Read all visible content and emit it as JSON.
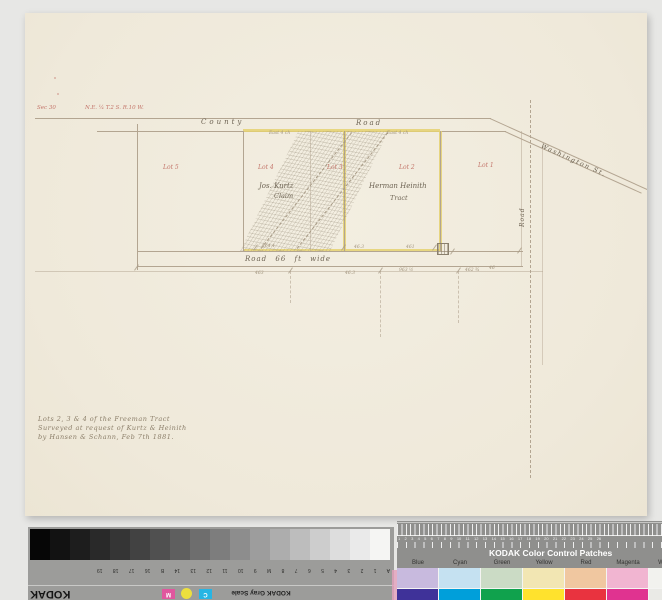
{
  "map": {
    "corner_note": {
      "section": "Sec 30",
      "township": "N.E. ¼  T.2 S.  R.10 W."
    },
    "labels": {
      "county": "County",
      "road_top": "Road",
      "washington": "Washington St.",
      "road_vertical": "Road",
      "road_bottom": "Road   66 ft wide"
    },
    "lots": [
      {
        "label": "Lot 5"
      },
      {
        "label": "Lot 4"
      },
      {
        "label": "Lot 3"
      },
      {
        "label": "Lot 2"
      },
      {
        "label": "Lot 1"
      }
    ],
    "tracts": [
      {
        "line1": "Jos. Kurtz",
        "line2": "Claim"
      },
      {
        "line1": "Herman Heinith",
        "line2": "Tract"
      }
    ],
    "measurements": {
      "east1": "East 4 ch",
      "east2": "East 4 ch",
      "m1": "464.4",
      "m2": "46.3",
      "m3": "461",
      "m4": "463",
      "m5": "46.3",
      "m6": "963 ½",
      "m7": "462 ¾",
      "m8": "46"
    },
    "caption": {
      "line1": "Lots 2, 3 & 4 of the Freeman Tract",
      "line2": "Surveyed at request of Kurtz & Heinith",
      "line3": "by Hansen & Schann, Feb 7th 1881."
    },
    "ink_colors": {
      "red_ink": "#c4766b",
      "dark_ink": "#6d6353",
      "yellow_highlight": "#e5d170"
    }
  },
  "gray_scale": {
    "brand": "KODAK",
    "title": "KODAK Gray Scale",
    "tick_labels": "A 1 2 3 4 5 6 7 8 M 9 10 11 12 13 14 B 16 17 18 19",
    "chips": {
      "magenta": "M",
      "cyan": "C"
    }
  },
  "color_patches": {
    "title": "KODAK Color Control Patches",
    "ruler_numbers": "1 2 3 4 5 6 7 8 9 10 11 12 13 14 15 16 17 18 19 20 21 22 23 24 25 26",
    "columns": [
      {
        "label": "Blue",
        "light": "#c8bade",
        "dark": "#3f3299"
      },
      {
        "label": "Cyan",
        "light": "#c5e1f1",
        "dark": "#009fda"
      },
      {
        "label": "Green",
        "light": "#cbdbc5",
        "dark": "#10a24d"
      },
      {
        "label": "Yellow",
        "light": "#f2e6b3",
        "dark": "#ffe22d"
      },
      {
        "label": "Red",
        "light": "#f0c7a0",
        "dark": "#e9333f"
      },
      {
        "label": "Magenta",
        "light": "#f1b5d1",
        "dark": "#e03390"
      },
      {
        "label": "W",
        "light": "#f2f2ee",
        "dark": "#eaeae6"
      }
    ]
  }
}
